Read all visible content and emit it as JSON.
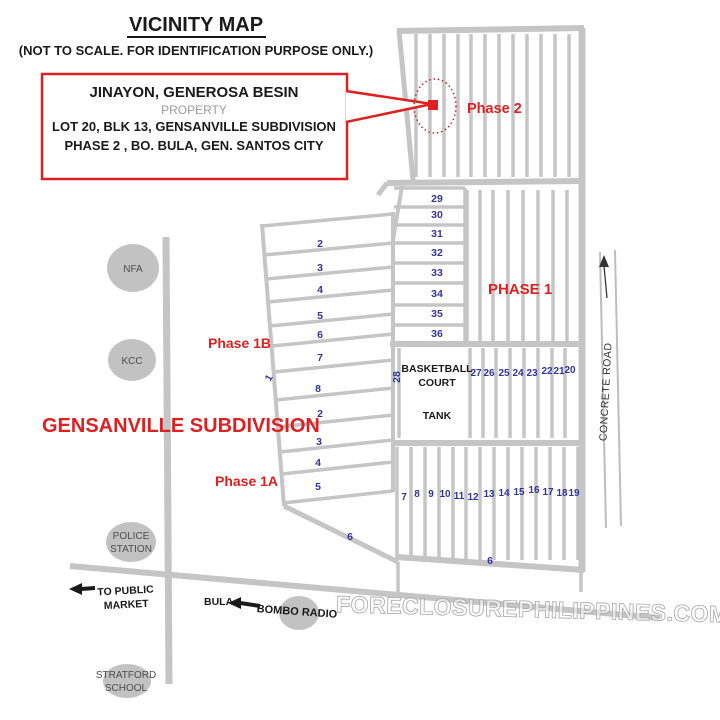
{
  "title": "VICINITY MAP",
  "subtitle": "(NOT TO SCALE. FOR IDENTIFICATION PURPOSE ONLY.)",
  "property_box": {
    "owner": "JINAYON, GENEROSA BESIN",
    "type_label": "PROPERTY",
    "address_line1": "LOT 20, BLK 13, GENSANVILLE SUBDIVISION",
    "address_line2": "PHASE 2 , BO. BULA,  GEN. SANTOS CITY"
  },
  "labels": {
    "phase2": "Phase 2",
    "phase1": "PHASE 1",
    "phase1b": "Phase 1B",
    "phase1a": "Phase 1A",
    "subdivision": "GENSANVILLE SUBDIVISION",
    "basketball_line1": "BASKETBALL",
    "basketball_line2": "COURT",
    "tank": "TANK",
    "concrete_road": "CONCRETE ROAD",
    "bula": "BULA",
    "to_public_market_line1": "TO PUBLIC",
    "to_public_market_line2": "MARKET",
    "bombo_radio": "BOMBO RADIO"
  },
  "landmarks": {
    "nfa": "NFA",
    "kcc": "KCC",
    "police_line1": "POLICE",
    "police_line2": "STATION",
    "school_line1": "STRATFORD",
    "school_line2": "SCHOOL"
  },
  "lot_numbers": {
    "block_29_36": [
      "29",
      "30",
      "31",
      "32",
      "33",
      "34",
      "35",
      "36"
    ],
    "strip_rows": [
      "2",
      "3",
      "4",
      "5",
      "6",
      "7",
      "8",
      "2",
      "3",
      "4",
      "5"
    ],
    "row_20_27": [
      "27",
      "26",
      "25",
      "24",
      "23",
      "22",
      "21",
      "20"
    ],
    "row_7_19": [
      "7",
      "8",
      "9",
      "10",
      "11",
      "12",
      "13",
      "14",
      "15",
      "16",
      "17",
      "18",
      "19"
    ],
    "lot_6_left": "6",
    "lot_6_bottom": "6",
    "lot_1": "1",
    "lot_28": "28"
  },
  "watermark": "FORECLOSUREPHILIPPINES.COM",
  "colors": {
    "road": "#c5c5c5",
    "red": "#dd2020",
    "blue": "#3333a0",
    "landmark": "#c2c2c2",
    "landmark-text": "#4d4d4d",
    "ink": "#1a1a1a",
    "gray-text": "#9a9a9a",
    "watermark": "#9a9a9a"
  }
}
